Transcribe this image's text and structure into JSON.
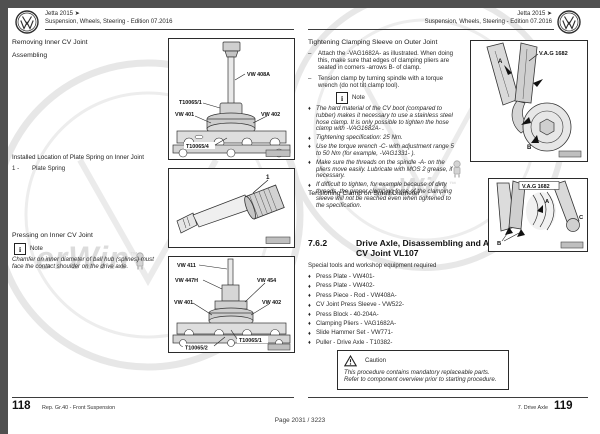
{
  "viewer": {
    "page_indicator": "Page 2031 / 3223"
  },
  "ui": {
    "dash": "–",
    "diamond": "♦",
    "note_glyph": "i",
    "caution_glyph": "!"
  },
  "watermark": {
    "text": "erWin",
    "tm": "™"
  },
  "left_page": {
    "header": {
      "line1": "Jetta 2015 ➤",
      "line2": "Suspension, Wheels, Steering - Edition 07.2016"
    },
    "removing_heading": "Removing Inner CV Joint",
    "assembling_heading": "Assembling",
    "installed_heading": "Installed Location of Plate Spring on Inner Joint",
    "legend_item": {
      "number": "1 -",
      "label": "Plate Spring"
    },
    "pressing_heading": "Pressing on Inner CV Joint",
    "note_label": "Note",
    "note_text": "Chamfer on inner diameter of ball hub (splines) must face the contact shoulder on the drive axle.",
    "fig_removal": {
      "vw408a": "VW 408A",
      "t10065_1": "T10065/1",
      "vw401": "VW 401",
      "vw402": "VW 402",
      "t10065_4": "T10065/4"
    },
    "fig_plate_spring": {
      "callout": "1"
    },
    "fig_install": {
      "vw411": "VW 411",
      "vw447h": "VW 447H",
      "vw454": "VW 454",
      "vw401": "VW 401",
      "vw402": "VW 402",
      "t10065_1": "T10065/1",
      "t10065_2": "T10065/2"
    },
    "footer": {
      "page_number": "118",
      "chapter": "Rep. Gr.40 - Front Suspension"
    }
  },
  "right_page": {
    "header": {
      "line1": "Jetta 2015 ➤",
      "line2": "Suspension, Wheels, Steering - Edition 07.2016"
    },
    "tightening_heading": "Tightening Clamping Sleeve on Outer Joint",
    "steps": [
      "Attach the -VAG1682A- as illustrated. When doing this, make sure that edges of clamping pliers are seated in corners -arrows B- of clamp.",
      "Tension clamp by turning spindle with a torque wrench (do not tilt clamp tool)."
    ],
    "note_label": "Note",
    "note_items": [
      "The hard material of the CV boot (compared to rubber) makes it necessary to use a stainless steel hose clamp. It is only possible to tighten the hose clamp with -VAG1682A- .",
      "Tightening specification: 25 Nm.",
      "Use the torque wrench -C- with adjustment range 5 to 50 Nm (for example, -VAG1331- ).",
      "Make sure the threads on the spindle -A- on the pliers move easily. Lubricate with MOS 2 grease, if necessary.",
      "If difficult to tighten, for example because of dirty threads, the proper clamping force of the clamping sleeve will not be reached even when tightened to the specification."
    ],
    "tensioning_heading": "Tensioning Clamp on Small Diameter",
    "section": {
      "number": "7.6.2",
      "title": "Drive Axle, Disassembling and Assembling, CV Joint VL107"
    },
    "tools_intro": "Special tools and workshop equipment required",
    "tools": [
      "Press Plate - VW401-",
      "Press Plate - VW402-",
      "Press Piece - Rod - VW408A-",
      "CV Joint Press Sleeve - VW522-",
      "Press Block - 40-204A-",
      "Clamping Pliers - VAG1682A-",
      "Slide Hammer Set - VW771-",
      "Puller - Drive Axle - T10382-"
    ],
    "caution": {
      "label": "Caution",
      "text": "This procedure contains mandatory replaceable parts. Refer to component overview prior to starting procedure."
    },
    "fig_outer": {
      "tool_label": "V.A.G 1682",
      "letter_a": "A",
      "letter_b": "B"
    },
    "fig_small": {
      "tool_label": "V.A.G 1682",
      "letter_a": "A",
      "letter_b": "B",
      "letter_c": "C"
    },
    "footer": {
      "chapter": "7. Drive Axle",
      "page_number": "119"
    }
  }
}
